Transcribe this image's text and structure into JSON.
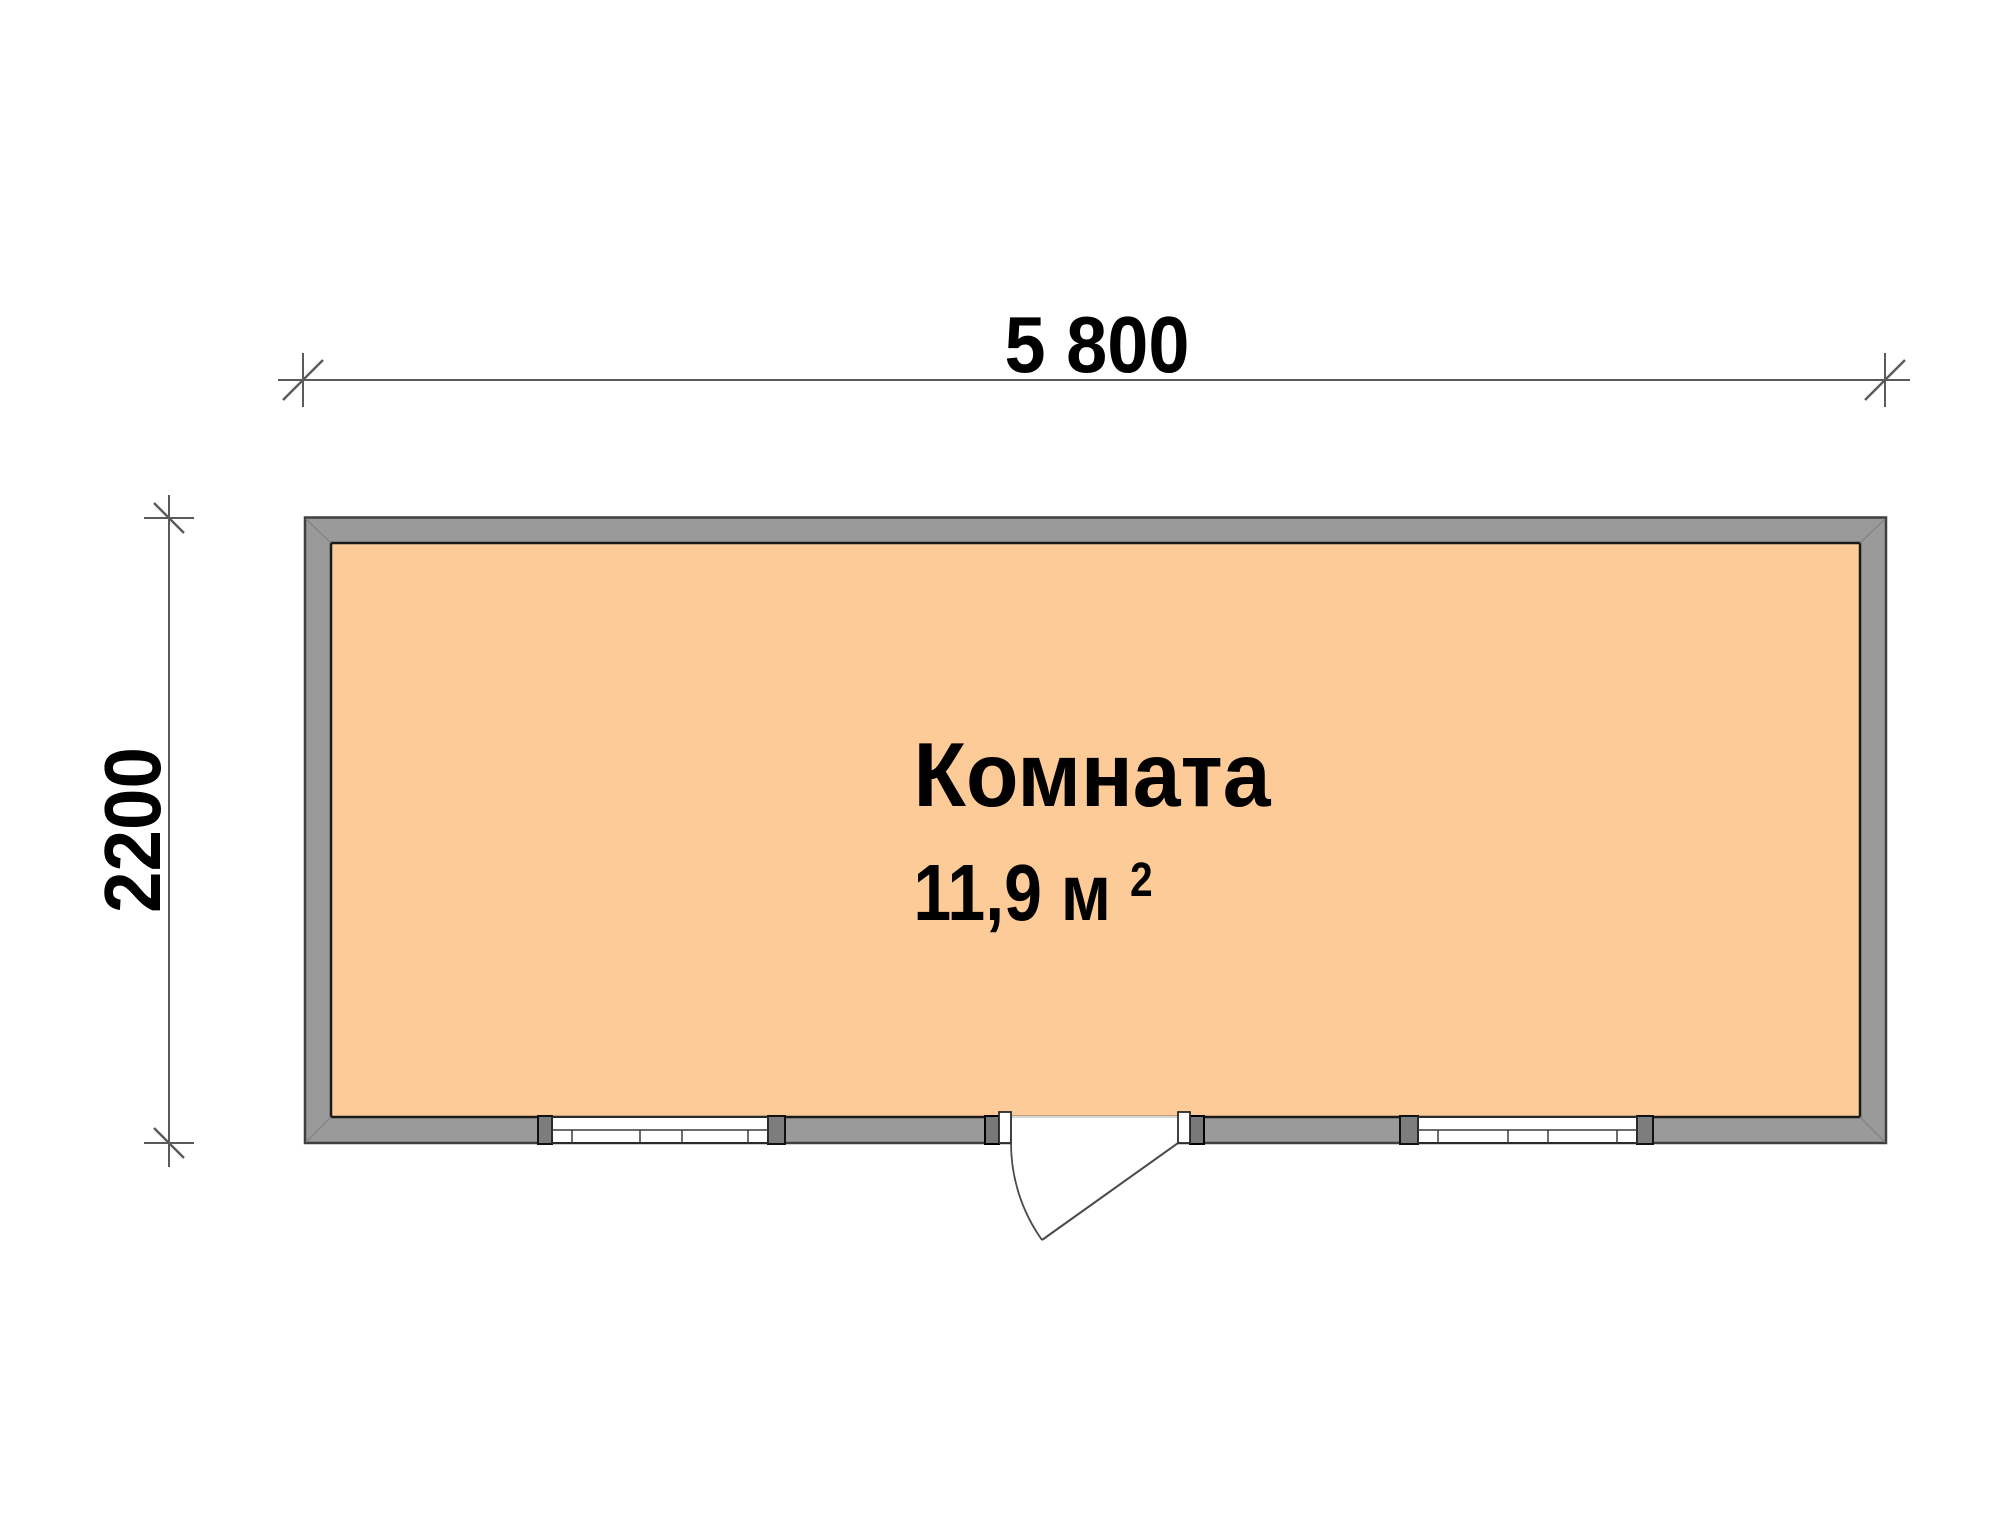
{
  "dimensions": {
    "width_label": "5 800",
    "height_label": "2200"
  },
  "room": {
    "name": "Комната",
    "area_label": "11,9 м",
    "area_exponent": "2"
  },
  "colors": {
    "floor_fill": "#FDCB97",
    "wall_fill": "#9A9A9A"
  }
}
